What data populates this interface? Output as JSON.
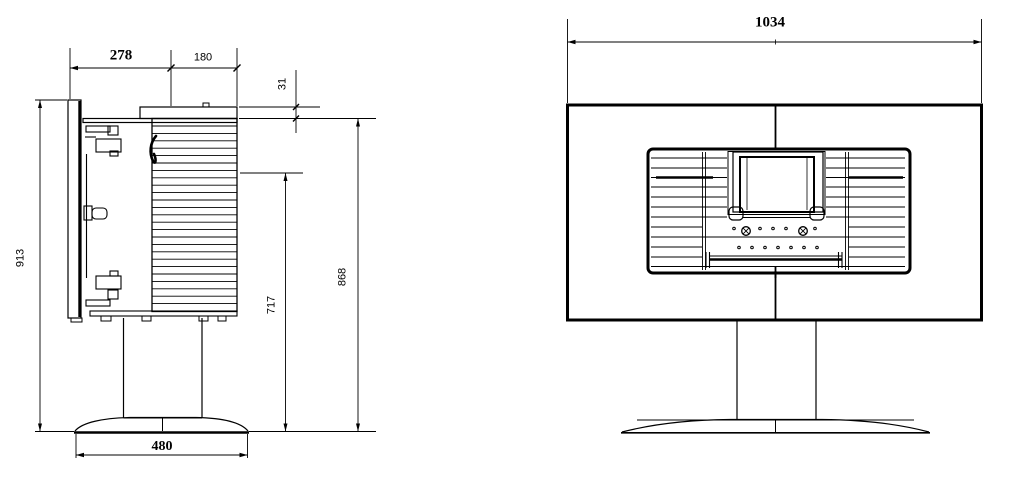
{
  "side_view": {
    "depth_overall": "278",
    "depth_fins": "180",
    "cap_thickness": "31",
    "height_overall": "913",
    "height_pivot": "717",
    "height_fins_top": "868",
    "base_diameter": "480"
  },
  "front_view": {
    "width_overall": "1034"
  },
  "colors": {
    "line": "#000000",
    "annotation_blue": "#2323cb",
    "background": "#ffffff"
  }
}
